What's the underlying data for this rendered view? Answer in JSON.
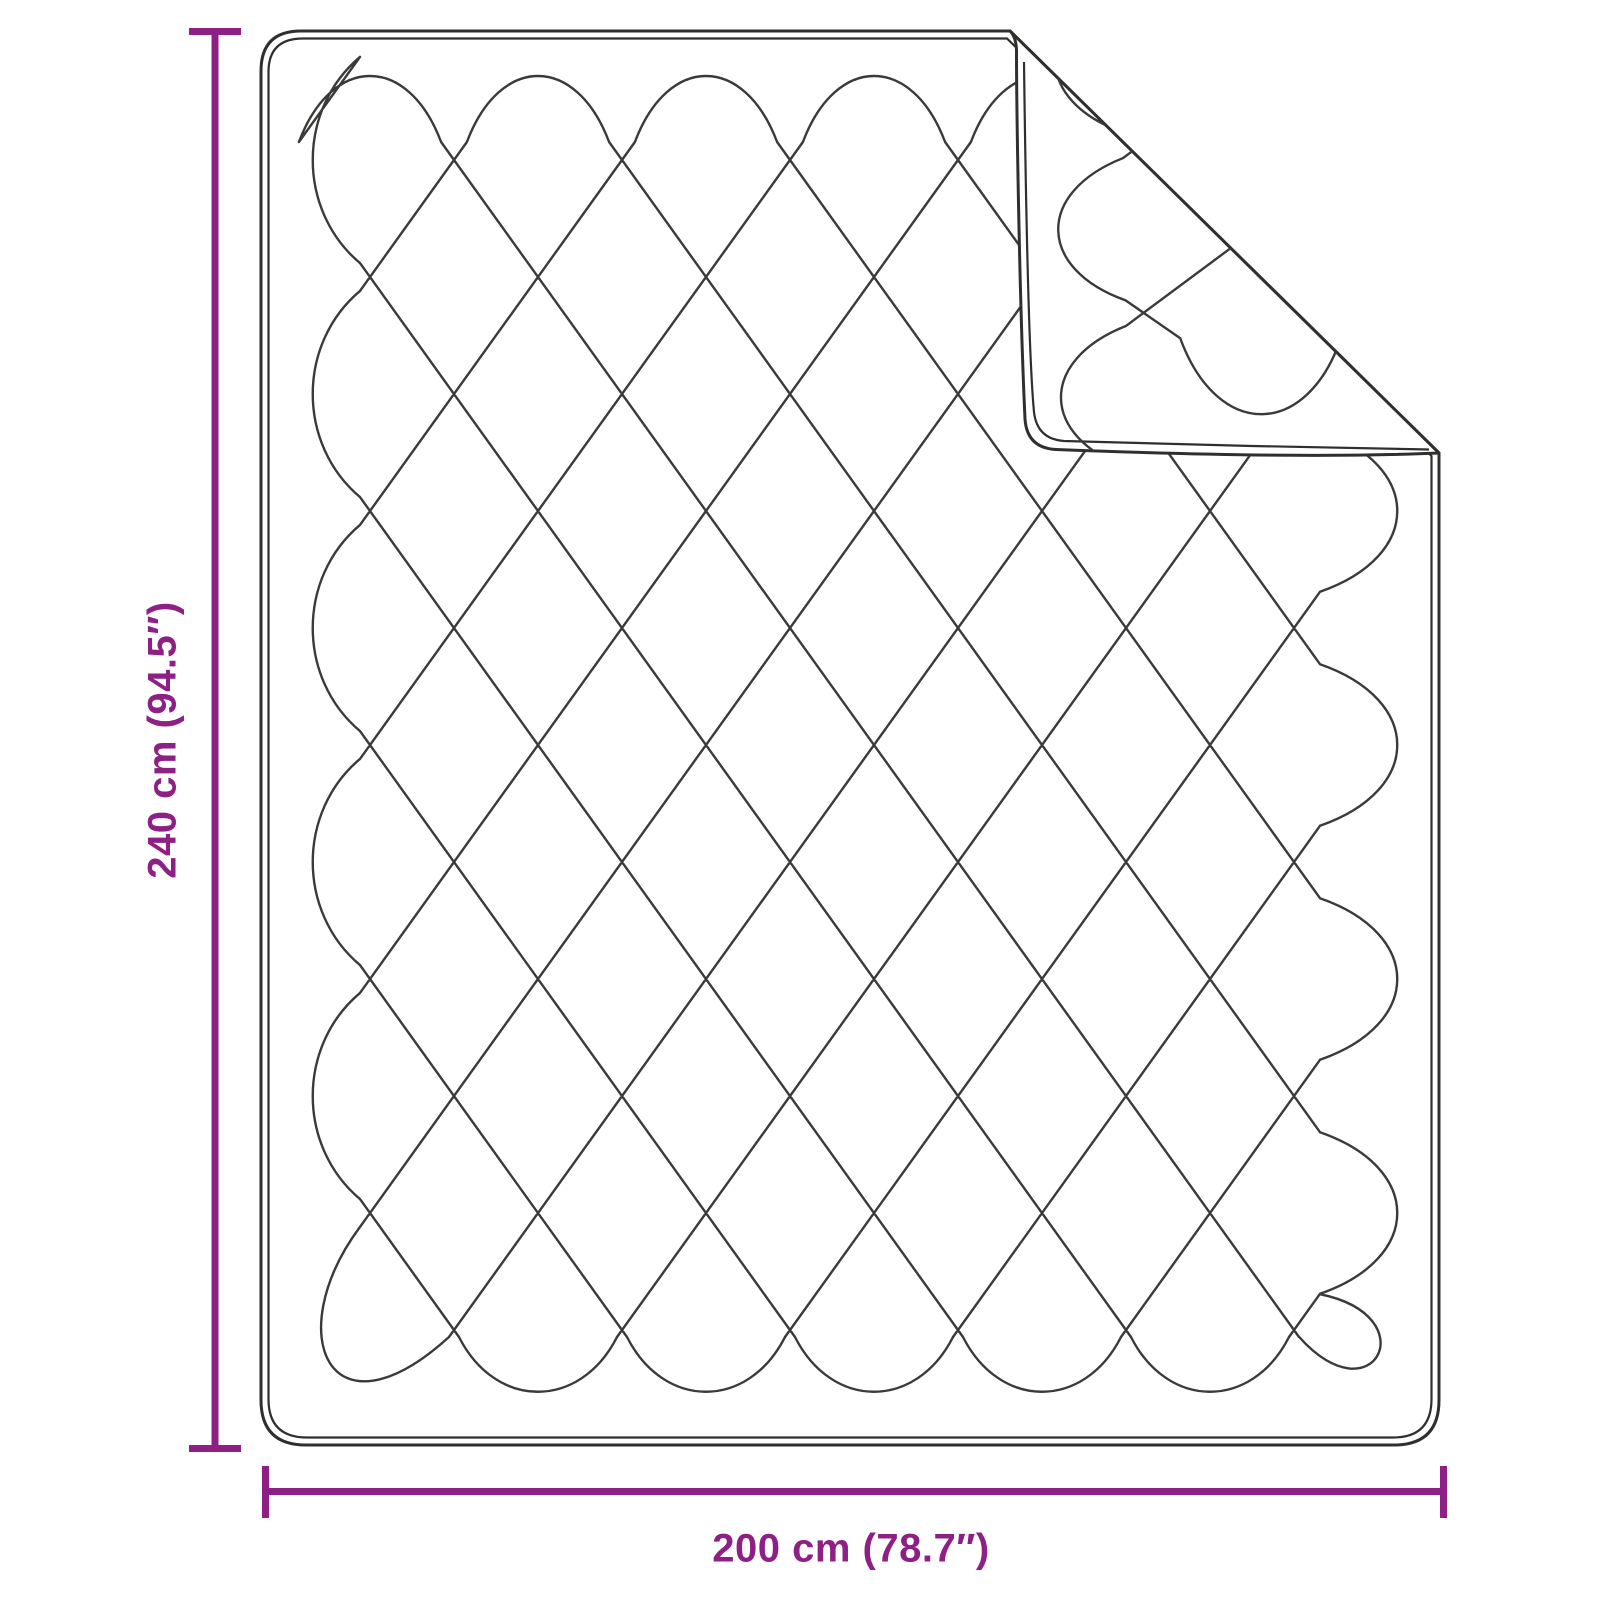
{
  "diagram": {
    "title": "Quilted blanket with folded corner - dimension diagram",
    "height_label": "240 cm (94.5″)",
    "width_label": "200 cm (78.7″)",
    "dimensions": {
      "height_cm": 240,
      "height_inches": 94.5,
      "width_cm": 200,
      "width_inches": 78.7
    },
    "colors": {
      "accent": "#8e1f84",
      "stitch_line": "#3a3a38",
      "border_line": "#2f2f2e",
      "background": "#ffffff"
    }
  }
}
